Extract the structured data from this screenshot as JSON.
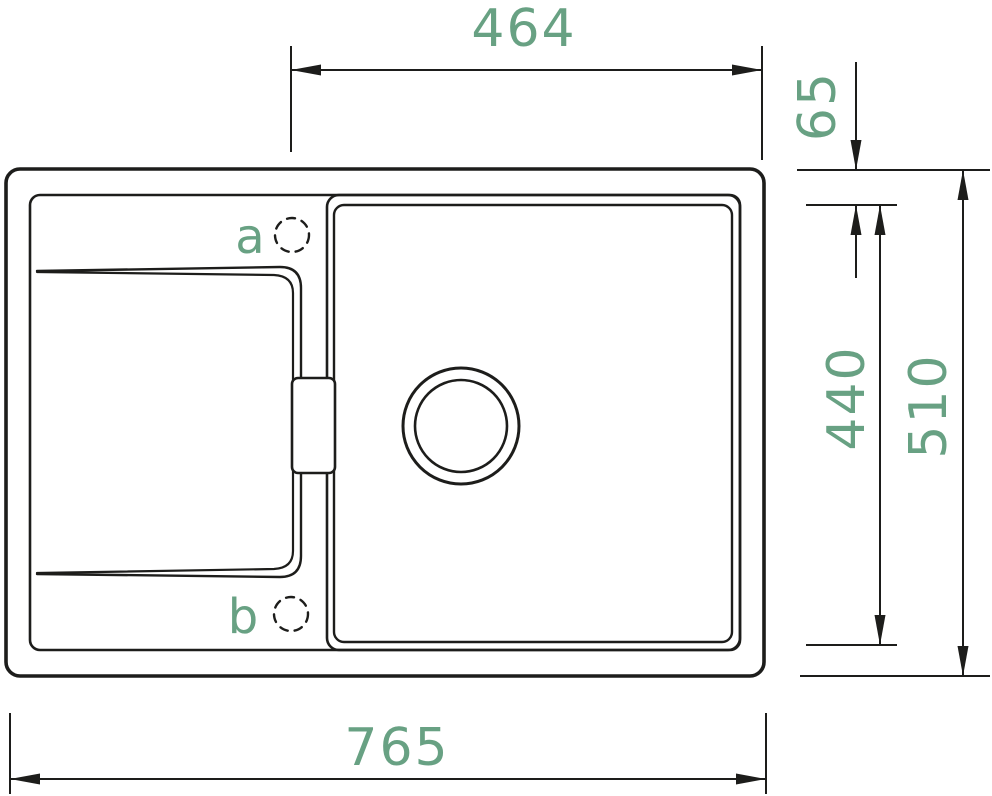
{
  "diagram": {
    "title": "sink-technical-drawing-top-view",
    "colors": {
      "line": "#1d1d1b",
      "dimension_text": "#68a183",
      "background": "#ffffff"
    },
    "dimensions": {
      "bowl_width_top": "464",
      "edge_to_bowl_offset": "65",
      "bowl_depth": "440",
      "overall_depth": "510",
      "overall_width": "765"
    },
    "tap_holes": {
      "hole_a_label": "a",
      "hole_b_label": "b"
    }
  }
}
